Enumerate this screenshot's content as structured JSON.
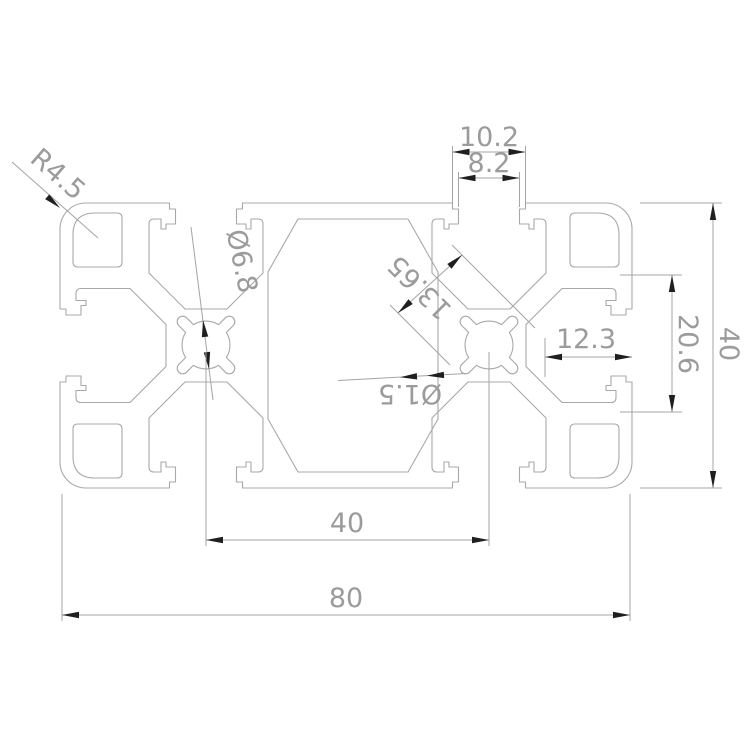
{
  "drawing": {
    "description": "Dimensioned cross-section drawing of an 80x40 T-slot aluminum extrusion profile",
    "colors": {
      "background": "#ffffff",
      "outline": "#a8a8a8",
      "dimension_line": "#a4a4a4",
      "dimension_text": "#9b9b9b",
      "arrowhead": "#1f1f1f"
    },
    "dimensions": {
      "top_slot_outer_width": "10.2",
      "top_slot_opening": "8.2",
      "corner_radius": "R4.5",
      "center_hole_diameter": "Ø6.8",
      "boss_diagonal_width": "13.65",
      "lobe_slot_width": "Ø1.5",
      "side_slot_depth": "12.3",
      "side_inner_height": "20.6",
      "profile_height": "40",
      "slot_center_spacing": "40",
      "profile_width": "80"
    }
  }
}
